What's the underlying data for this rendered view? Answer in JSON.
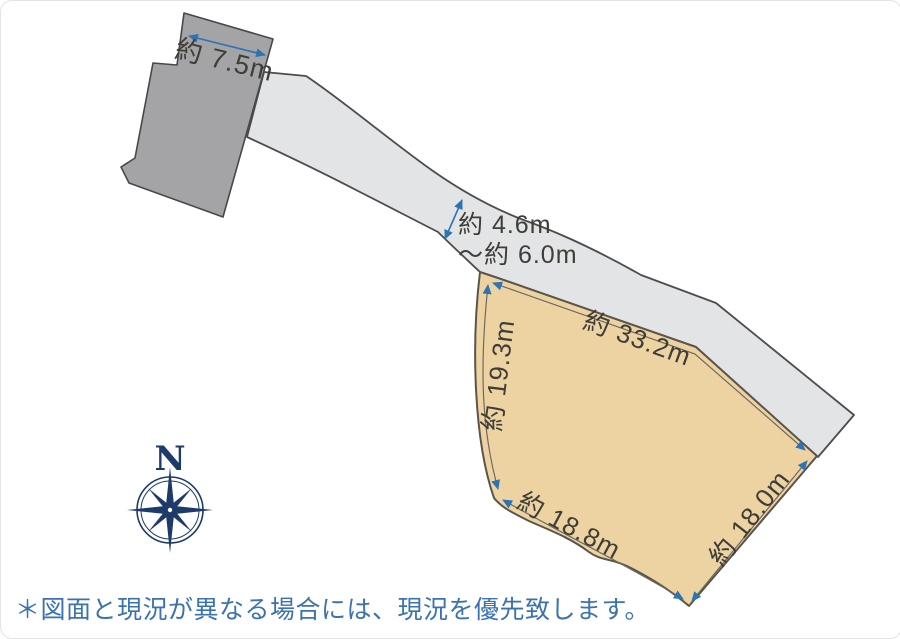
{
  "diagram": {
    "title_hint": "land-plot-site-plan",
    "dimensions": {
      "building_width": "約 7.5m",
      "road_width_line1": "約 4.6m",
      "road_width_line2": "～約 6.0m",
      "parcel_edge_top": "約 33.2m",
      "parcel_edge_left": "約 19.3m",
      "parcel_edge_bottom": "約 18.8m",
      "parcel_edge_right": "約 18.0m"
    },
    "compass": {
      "north": "N"
    },
    "note": "＊図面と現況が異なる場合には、現況を優先致します。",
    "colors": {
      "background": "#ffffff",
      "parcel_fill": "#edd3a2",
      "parcel_stroke": "#5c544a",
      "road_fill": "#e3e4e6",
      "road_stroke": "#4c4c4e",
      "building_fill": "#a4a4a6",
      "building_stroke": "#48484a",
      "dimension_line": "#6f6a60",
      "arrow_blue": "#2e74b5",
      "label_text": "#3e3d38",
      "note_text": "#3a72b2",
      "compass_navy": "#1d3a6a"
    }
  }
}
